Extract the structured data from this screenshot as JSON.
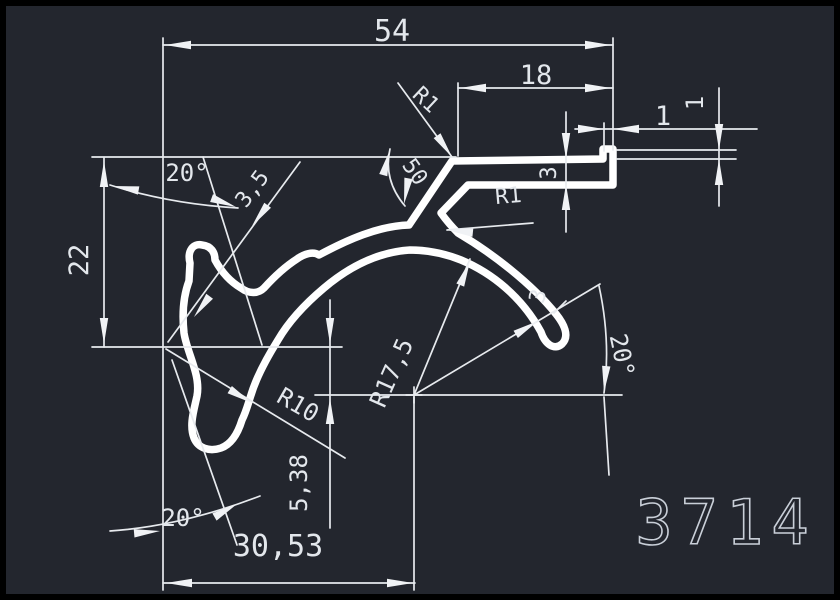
{
  "drawing": {
    "type": "CAD profile cross-section drawing",
    "profile_number": "3714",
    "colors": {
      "background": "#23262e",
      "frame": "#000000",
      "profile_line": "#ffffff",
      "dimension_line": "#e7eaee",
      "text": "#e3e7ec",
      "profile_number_text": "#c9cfd8"
    },
    "labels": {
      "width_total": "54",
      "flange_length": "18",
      "lip_width": "1",
      "lip_height": "1",
      "flange_thickness": "3",
      "junction_angle": "50",
      "fillet_top": "R1",
      "fillet_neck": "R1",
      "slot_width": "3,5",
      "angle_top_left": "20°",
      "height_left": "22",
      "crescent_radius": "R10",
      "center_offset_vertical": "5,38",
      "center_offset_horizontal": "30,53",
      "arch_radius": "R17,5",
      "arm_thickness": "3",
      "angle_right": "20°",
      "angle_bottom_left": "20°"
    }
  }
}
